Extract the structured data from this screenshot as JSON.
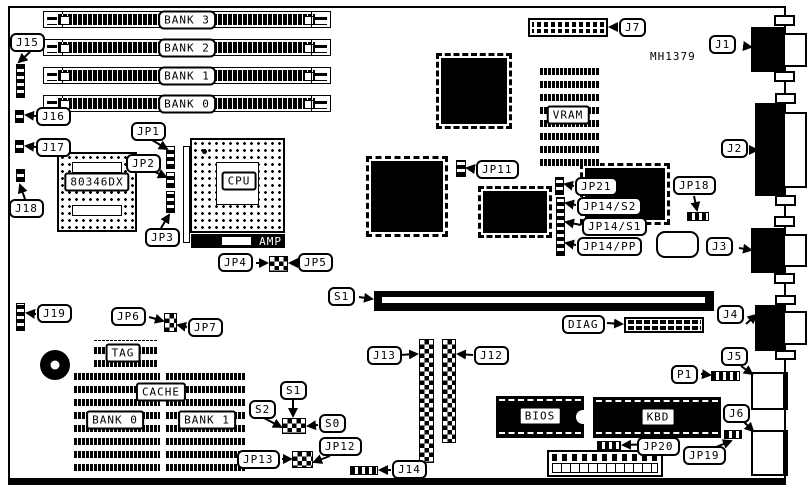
{
  "board": {
    "part_number": "MH1379"
  },
  "simm": {
    "bank3": "BANK 3",
    "bank2": "BANK 2",
    "bank1": "BANK 1",
    "bank0": "BANK 0"
  },
  "chips": {
    "coprocessor": "80346DX",
    "cpu": "CPU",
    "amp": "AMP",
    "vram": "VRAM",
    "tag": "TAG",
    "cache": "CACHE",
    "cache_bank0": "BANK 0",
    "cache_bank1": "BANK 1",
    "bios": "BIOS",
    "kbd": "KBD"
  },
  "connectors": {
    "j1": "J1",
    "j2": "J2",
    "j3": "J3",
    "j4": "J4",
    "j5": "J5",
    "j6": "J6",
    "j7": "J7",
    "j12": "J12",
    "j13": "J13",
    "j14": "J14",
    "j15": "J15",
    "j16": "J16",
    "j17": "J17",
    "j18": "J18",
    "j19": "J19",
    "p1": "P1",
    "diag": "DIAG",
    "s1_slot": "S1"
  },
  "jumpers": {
    "jp1": "JP1",
    "jp2": "JP2",
    "jp3": "JP3",
    "jp4": "JP4",
    "jp5": "JP5",
    "jp6": "JP6",
    "jp7": "JP7",
    "jp11": "JP11",
    "jp12": "JP12",
    "jp13": "JP13",
    "jp18": "JP18",
    "jp19": "JP19",
    "jp20": "JP20",
    "jp21": "JP21",
    "jp14_s2": "JP14/S2",
    "jp14_s1": "JP14/S1",
    "jp14_pp": "JP14/PP",
    "s0": "S0",
    "s1": "S1",
    "s2": "S2"
  }
}
